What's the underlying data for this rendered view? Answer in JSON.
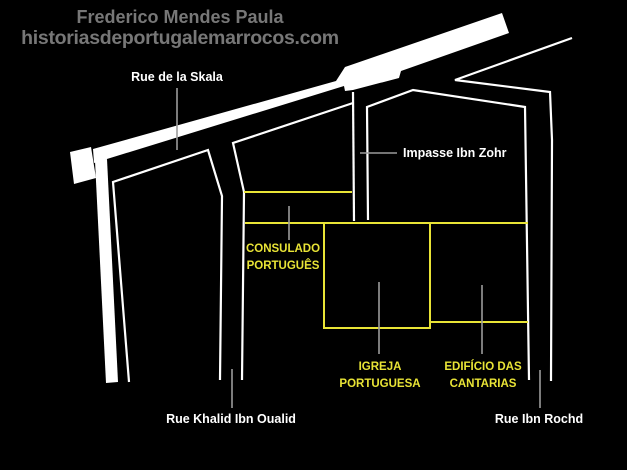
{
  "header": {
    "author": "Frederico Mendes Paula",
    "site": "historiasdeportugalemarrocos.com"
  },
  "map": {
    "street_labels": {
      "skala": "Rue de la Skala",
      "impasse": "Impasse Ibn Zohr",
      "khalid": "Rue Khalid Ibn Oualid",
      "rochd": "Rue Ibn Rochd"
    },
    "building_labels": {
      "consulado": {
        "line1": "CONSULADO",
        "line2": "PORTUGUÊS"
      },
      "igreja": {
        "line1": "IGREJA",
        "line2": "PORTUGUESA"
      },
      "cantarias": {
        "line1": "EDIFÍCIO DAS",
        "line2": "CANTARIAS"
      }
    },
    "colors": {
      "background": "#000000",
      "street_fill": "#ffffff",
      "street_outline": "#ffffff",
      "building_outline": "#e9e436",
      "building_label_text": "#e9e436",
      "street_label_text": "#ffffff",
      "header_text": "#777777",
      "leader_line": "#9b9b9b"
    }
  }
}
